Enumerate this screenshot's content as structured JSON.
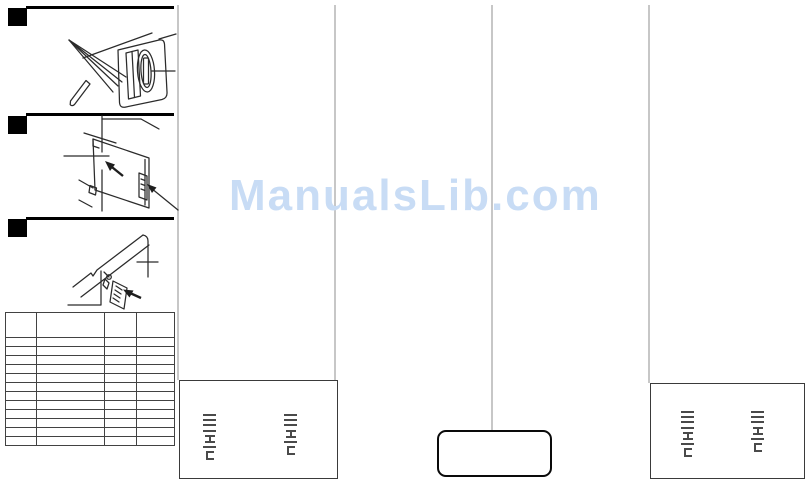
{
  "watermark": {
    "text": "ManualsLib.com",
    "color": "#c8dcf5"
  },
  "steps": [
    {
      "name": "step-1",
      "marker": "black-square",
      "illustration": "stylus-inserted-into-connector-slot"
    },
    {
      "name": "step-2",
      "marker": "black-square",
      "illustration": "card-plate-with-insertion-arrows"
    },
    {
      "name": "step-3",
      "marker": "black-square",
      "illustration": "angled-rail-with-small-plate-and-cross-mark"
    }
  ],
  "table": {
    "columns": 4,
    "header_rows": 1,
    "body_rows": 12,
    "visible_text": ""
  },
  "thumb_boxes": [
    {
      "name": "bottom-left-box",
      "stacks": [
        [
          "dash",
          "dash",
          "dash",
          "dash",
          "ibeam",
          "dash",
          "cbr"
        ],
        [
          "dash",
          "dash",
          "dash",
          "ibeam",
          "dash",
          "cbr"
        ]
      ]
    },
    {
      "name": "bottom-center-rounded-box",
      "stacks": []
    },
    {
      "name": "bottom-right-box",
      "stacks": [
        [
          "dash",
          "dash",
          "dash",
          "dash",
          "ibeam",
          "dash",
          "cbr"
        ],
        [
          "dash",
          "dash",
          "dash",
          "ibeam",
          "dash",
          "cbr"
        ]
      ]
    }
  ],
  "colors": {
    "separator_line": "#c7c7c7",
    "diagram_ink": "#2b2b2b",
    "micro_mark": "#4a4a4a",
    "watermark_blue": "#c8dcf5"
  }
}
